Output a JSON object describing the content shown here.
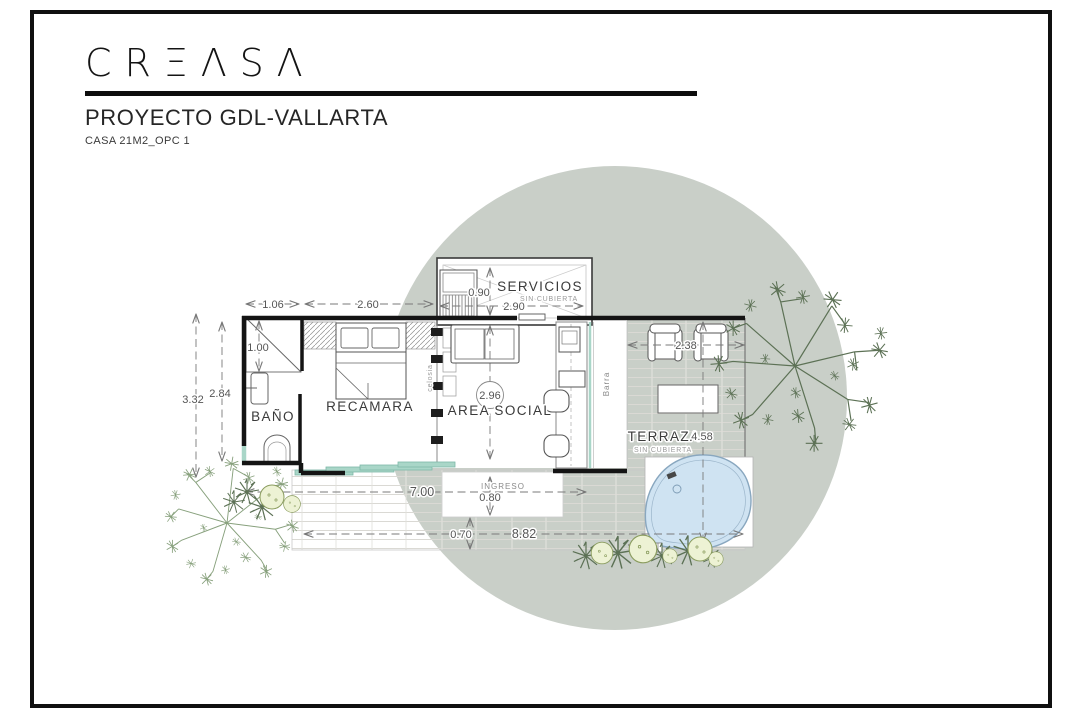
{
  "header": {
    "brand": "CRΞΛSΛ",
    "title": "PROYECTO GDL-VALLARTA",
    "subtitle": "CASA 21M2_OPC 1"
  },
  "plan": {
    "rooms": {
      "bano": "BAÑO",
      "recamara": "RECAMARA",
      "area_social": "AREA SOCIAL",
      "servicios": "SERVICIOS",
      "terraza": "TERRAZA",
      "sin_cubierta": "SIN CUBIERTA",
      "ingreso": "INGRESO",
      "barra": "Barra",
      "celosia": "celosia"
    },
    "dims": {
      "bath_width": "1.06",
      "bed_width": "2.60",
      "serv_depth": "0.90",
      "serv_width": "2.90",
      "shower": "1.00",
      "interior_depth": "2.84",
      "total_depth": "3.32",
      "social_depth": "2.96",
      "chairs": "2.38",
      "terraza_depth": "4.58",
      "house_width": "7.00",
      "entry": "0.80",
      "deck": "0.70",
      "total_width": "8.82"
    },
    "colors": {
      "site_circle": "#c9cfc8",
      "pool_fill": "#cfe3f2",
      "pool_stroke": "#89a7bf",
      "glass": "#a9d6c8",
      "tree_dark": "#5c7155",
      "tree_light": "#87a07c",
      "bush_fill": "#edf2d4",
      "bush_stroke": "#8a9c5e",
      "wall": "#141414"
    }
  }
}
